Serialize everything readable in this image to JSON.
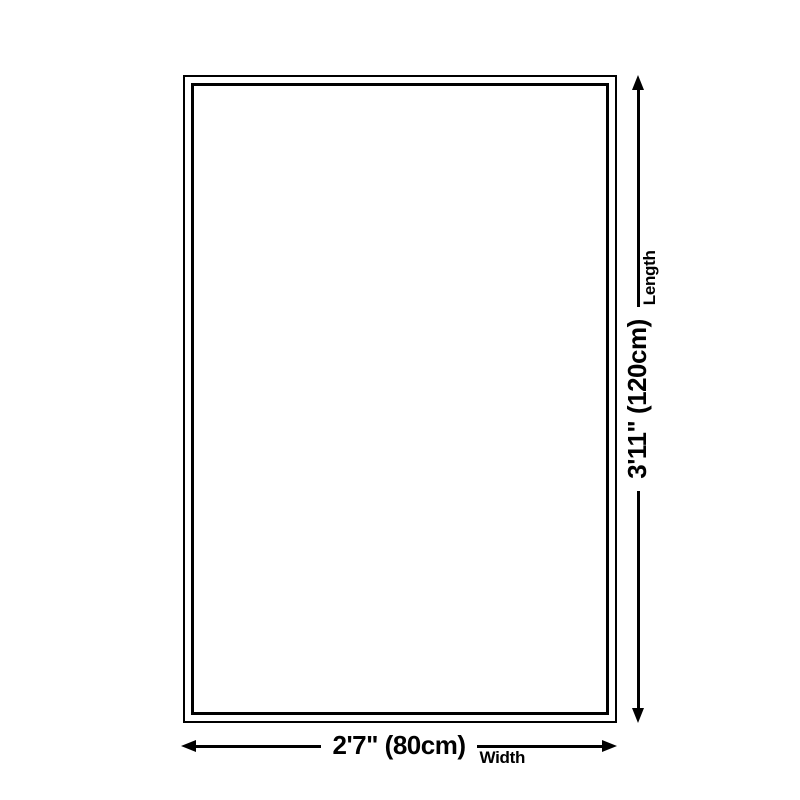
{
  "diagram": {
    "description": "Rectangular size diagram with double border and dimension arrows",
    "colors": {
      "line": "#000000",
      "background": "#ffffff"
    },
    "dimensions": {
      "length": {
        "value": "3'11\" (120cm)",
        "label": "Length"
      },
      "width": {
        "value": "2'7\" (80cm)",
        "label": "Width"
      }
    }
  }
}
